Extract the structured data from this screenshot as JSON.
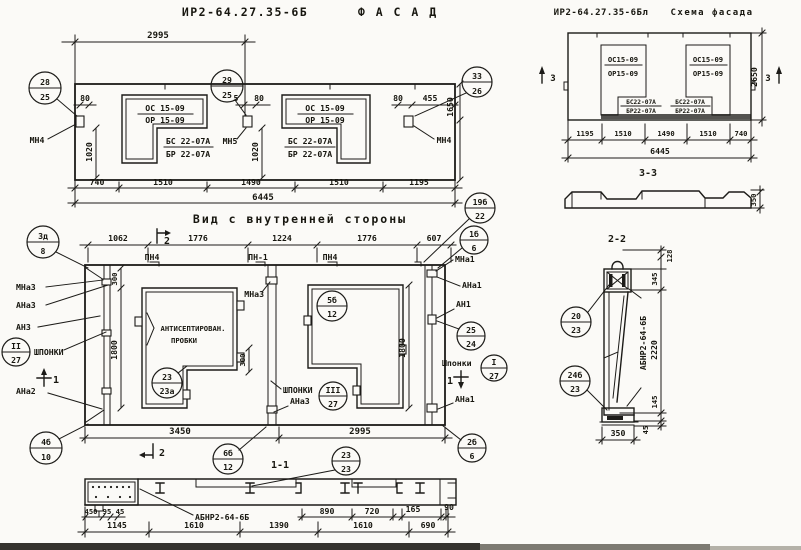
{
  "facade": {
    "code": "ИР2-64.27.35-6Б",
    "title": "Ф А С А Д",
    "dim_2995": "2995",
    "win_left_top": "ОС 15-09",
    "win_left_bot": "ОР 15-09",
    "blk_left_top": "БС 22-07А",
    "blk_left_bot": "БР 22-07А",
    "win_right_top": "ОС 15-09",
    "win_right_bot": "ОР 15-09",
    "blk_right_top": "БС 22-07А",
    "blk_right_bot": "БР 22-07А",
    "mn4_left": "МН4",
    "mn5": "МН5",
    "mn4_right": "МН4",
    "d80_left": "80",
    "d1020_left": "1020",
    "d5": "5",
    "d80_mid": "80",
    "d1020_mid": "1020",
    "d80_right": "80",
    "d455": "455",
    "d1650": "1650",
    "d740": "740",
    "d1510a": "1510",
    "d1490": "1490",
    "d1510b": "1510",
    "d1195": "1195",
    "d6445": "6445",
    "c28_top": "28",
    "c28_bot": "25",
    "c29_top": "29",
    "c29_bot": "25",
    "c33_top": "33",
    "c33_bot": "26"
  },
  "scheme": {
    "code": "ИР2-64.27.35-6Бл",
    "title": "Схема фасада",
    "win_left_top": "ОС15-09",
    "win_left_bot": "ОР15-09",
    "blk_left_top": "БС22-07А",
    "blk_left_bot": "БР22-07А",
    "win_right_top": "ОС15-09",
    "win_right_bot": "ОР15-09",
    "blk_right_top": "БС22-07А",
    "blk_right_bot": "БР22-07А",
    "mark3_left": "3",
    "mark3_right": "3",
    "d2650": "2650",
    "d1195": "1195",
    "d1510a": "1510",
    "d1490": "1490",
    "d1510b": "1510",
    "d740": "740",
    "d6445": "6445",
    "sec33": "3-3",
    "d350": "350"
  },
  "inner": {
    "title": "Вид с внутренней стороны",
    "d1062": "1062",
    "d1776a": "1776",
    "d1224": "1224",
    "d1776b": "1776",
    "d607": "607",
    "pn4_a": "ПН4",
    "pn1": "ПН-1",
    "pn4_b": "ПН4",
    "mark2_top": "2",
    "mark2_bot": "2",
    "mark1_left": "1",
    "mark1_right": "1",
    "mna3_left": "МНа3",
    "ana3_left": "АНа3",
    "an3": "АН3",
    "shponki_left": "ШПОНКИ",
    "ana2": "АНа2",
    "cII_top": "II",
    "cII_bot": "27",
    "mna3_mid": "МНа3",
    "plugs1": "АНТИСЕПТИРОВАН.",
    "plugs2": "ПРОБКИ",
    "shponki_mid": "ШПОНКИ",
    "cIII_top": "III",
    "cIII_bot": "27",
    "ana3_mid": "АНа3",
    "mna1": "МНа1",
    "ana1_top": "АНа1",
    "an1": "АН1",
    "shponki_right": "Шпонки",
    "cI_top": "I",
    "cI_bot": "27",
    "ana1_bot": "АНа1",
    "d300a": "300",
    "d1800l": "1800",
    "d300b": "300",
    "d1800r": "1800",
    "d3450": "3450",
    "d2995": "2995",
    "c3d_top": "3д",
    "c3d_bot": "8",
    "c19b_top": "19б",
    "c19b_bot": "22",
    "c1b_top": "1б",
    "c1b_bot": "6",
    "c5b_top": "5б",
    "c5b_bot": "12",
    "c23_top": "23",
    "c23_bot": "23а",
    "c25_top": "25",
    "c25_bot": "24",
    "c4b_top": "4б",
    "c4b_bot": "10",
    "c6b_top": "6б",
    "c6b_bot": "12",
    "c2b_top": "2б",
    "c2b_bot": "6"
  },
  "sec11": {
    "title": "1-1",
    "label": "АБНР2-64-6Б",
    "c23_top": "23",
    "c23_bot": "23",
    "d450": "450",
    "d95": "95",
    "d45": "45",
    "d890": "890",
    "d720": "720",
    "d165": "165",
    "d90": "90",
    "d1145": "1145",
    "d1610a": "1610",
    "d1390": "1390",
    "d1610b": "1610",
    "d690": "690"
  },
  "sec22": {
    "title": "2-2",
    "label": "АБНР2-64-6Б",
    "c20_top": "20",
    "c20_bot": "23",
    "c24b_top": "24б",
    "c24b_bot": "23",
    "d128": "128",
    "d345": "345",
    "d2220": "2220",
    "d145": "145",
    "d45": "45",
    "d350": "350"
  },
  "colors": {
    "ink": "#1c1b18",
    "paper": "#fbfaf7"
  }
}
